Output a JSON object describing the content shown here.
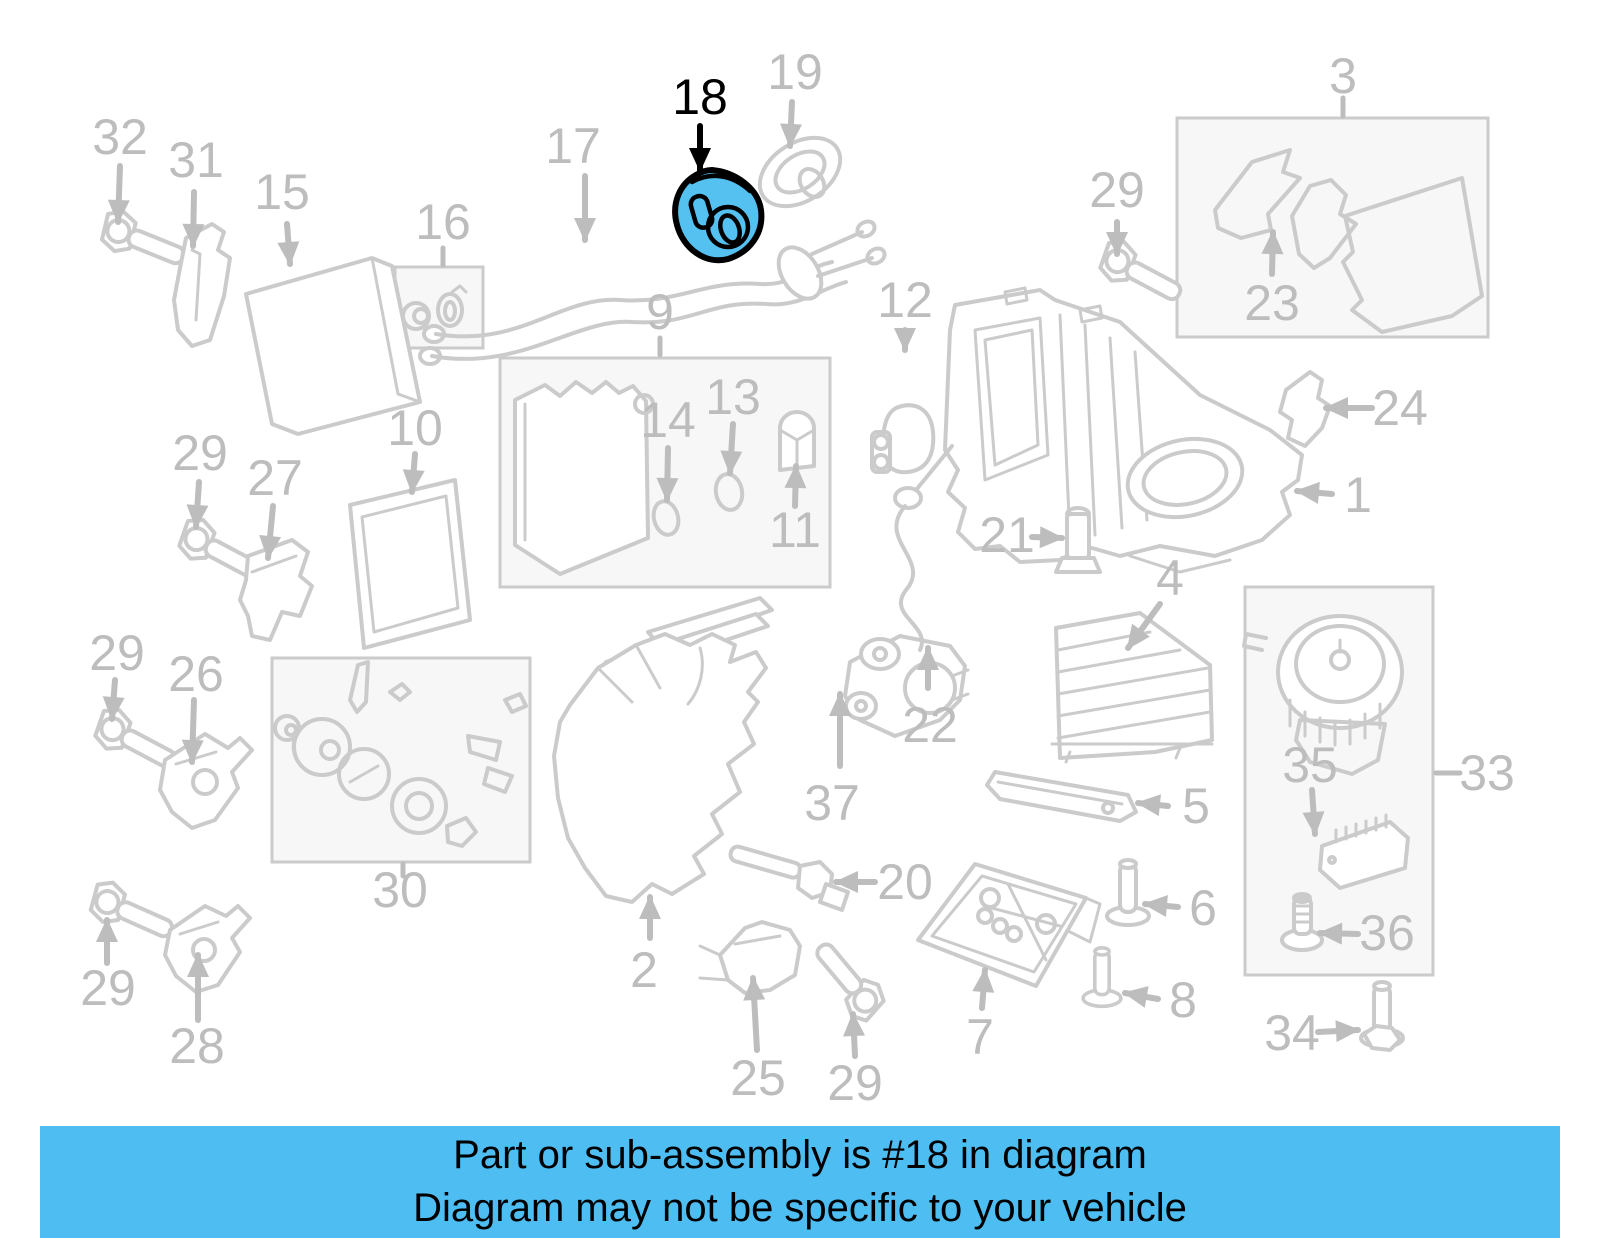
{
  "diagram": {
    "type": "exploded-parts-diagram",
    "highlighted_part": "18",
    "colors": {
      "line-color": "#CBCBCB",
      "label-color": "#BDBDBD",
      "panel-fill": "#F7F7F7",
      "highlight-fill": "#55C1F0",
      "highlight-outline": "#000000",
      "banner-bg": "#4DBDF2",
      "banner-text": "#000000"
    },
    "labels": [
      {
        "text": "32",
        "x": 120,
        "y": 137
      },
      {
        "text": "31",
        "x": 196,
        "y": 160
      },
      {
        "text": "15",
        "x": 282,
        "y": 192
      },
      {
        "text": "17",
        "x": 573,
        "y": 146
      },
      {
        "text": "18",
        "x": 700,
        "y": 97,
        "highlight": true
      },
      {
        "text": "19",
        "x": 795,
        "y": 72
      },
      {
        "text": "3",
        "x": 1343,
        "y": 76
      },
      {
        "text": "29",
        "x": 1117,
        "y": 190
      },
      {
        "text": "23",
        "x": 1272,
        "y": 303
      },
      {
        "text": "24",
        "x": 1400,
        "y": 408
      },
      {
        "text": "1",
        "x": 1358,
        "y": 495
      },
      {
        "text": "12",
        "x": 905,
        "y": 300
      },
      {
        "text": "16",
        "x": 443,
        "y": 222
      },
      {
        "text": "9",
        "x": 660,
        "y": 312
      },
      {
        "text": "14",
        "x": 668,
        "y": 420
      },
      {
        "text": "13",
        "x": 733,
        "y": 397
      },
      {
        "text": "11",
        "x": 795,
        "y": 530
      },
      {
        "text": "10",
        "x": 415,
        "y": 428
      },
      {
        "text": "29",
        "x": 200,
        "y": 453
      },
      {
        "text": "27",
        "x": 275,
        "y": 478
      },
      {
        "text": "29",
        "x": 117,
        "y": 653
      },
      {
        "text": "26",
        "x": 196,
        "y": 674
      },
      {
        "text": "30",
        "x": 400,
        "y": 890
      },
      {
        "text": "29",
        "x": 108,
        "y": 988
      },
      {
        "text": "28",
        "x": 197,
        "y": 1046
      },
      {
        "text": "2",
        "x": 644,
        "y": 970
      },
      {
        "text": "25",
        "x": 758,
        "y": 1078
      },
      {
        "text": "29",
        "x": 855,
        "y": 1083
      },
      {
        "text": "7",
        "x": 980,
        "y": 1037
      },
      {
        "text": "20",
        "x": 905,
        "y": 882
      },
      {
        "text": "37",
        "x": 832,
        "y": 803
      },
      {
        "text": "22",
        "x": 930,
        "y": 725
      },
      {
        "text": "21",
        "x": 1007,
        "y": 535
      },
      {
        "text": "4",
        "x": 1170,
        "y": 578
      },
      {
        "text": "5",
        "x": 1196,
        "y": 806
      },
      {
        "text": "33",
        "x": 1487,
        "y": 773
      },
      {
        "text": "35",
        "x": 1310,
        "y": 765
      },
      {
        "text": "36",
        "x": 1387,
        "y": 933
      },
      {
        "text": "34",
        "x": 1292,
        "y": 1033
      },
      {
        "text": "6",
        "x": 1203,
        "y": 908
      },
      {
        "text": "8",
        "x": 1183,
        "y": 1000
      }
    ]
  },
  "banner": {
    "line1": "Part or sub-assembly is #18 in diagram",
    "line2": "Diagram may not be specific to your vehicle"
  }
}
